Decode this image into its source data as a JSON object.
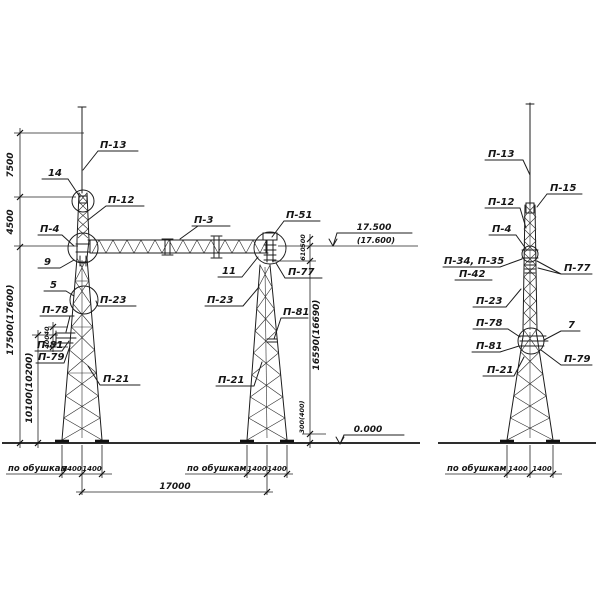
{
  "view_front": {
    "labels": {
      "p13": "П-13",
      "n14": "14",
      "p12": "П-12",
      "p4": "П-4",
      "n9": "9",
      "n5": "5",
      "p23_left": "П-23",
      "p78": "П-78",
      "p81_left": "П-81",
      "p79": "П-79",
      "p21_left": "П-21",
      "p3": "П-3",
      "p51": "П-51",
      "n11": "11",
      "p77": "П-77",
      "p23_right": "П-23",
      "p81_right": "П-81",
      "p21_right": "П-21"
    },
    "dims": {
      "h7500": "7500",
      "h4500": "4500",
      "h_total": "17500(17600)",
      "h_lower": "10100(10200)",
      "d40": "40",
      "d400": "400",
      "d500": "500",
      "d610": "610",
      "h_right": "16590(16690)",
      "d300": "300(400)",
      "span": "17000",
      "base1_a": "1400",
      "base1_b": "1400",
      "base2_a": "1400",
      "base2_b": "1400"
    },
    "elev": {
      "top": "17.500",
      "top_alt": "(17.600)",
      "ground": "0.000"
    },
    "notes": {
      "po_obushkam_1": "по обушкам",
      "po_obushkam_2": "по обушкам"
    }
  },
  "view_side": {
    "labels": {
      "p13": "П-13",
      "p15": "П-15",
      "p12": "П-12",
      "p4": "П-4",
      "p34_35": "П-34, П-35",
      "p42": "П-42",
      "p77": "П-77",
      "p23": "П-23",
      "p78": "П-78",
      "n7": "7",
      "p81": "П-81",
      "p79": "П-79",
      "p21": "П-21"
    },
    "dims": {
      "base_a": "1400",
      "base_b": "1400"
    },
    "notes": {
      "po_obushkam": "по обушкам"
    }
  }
}
